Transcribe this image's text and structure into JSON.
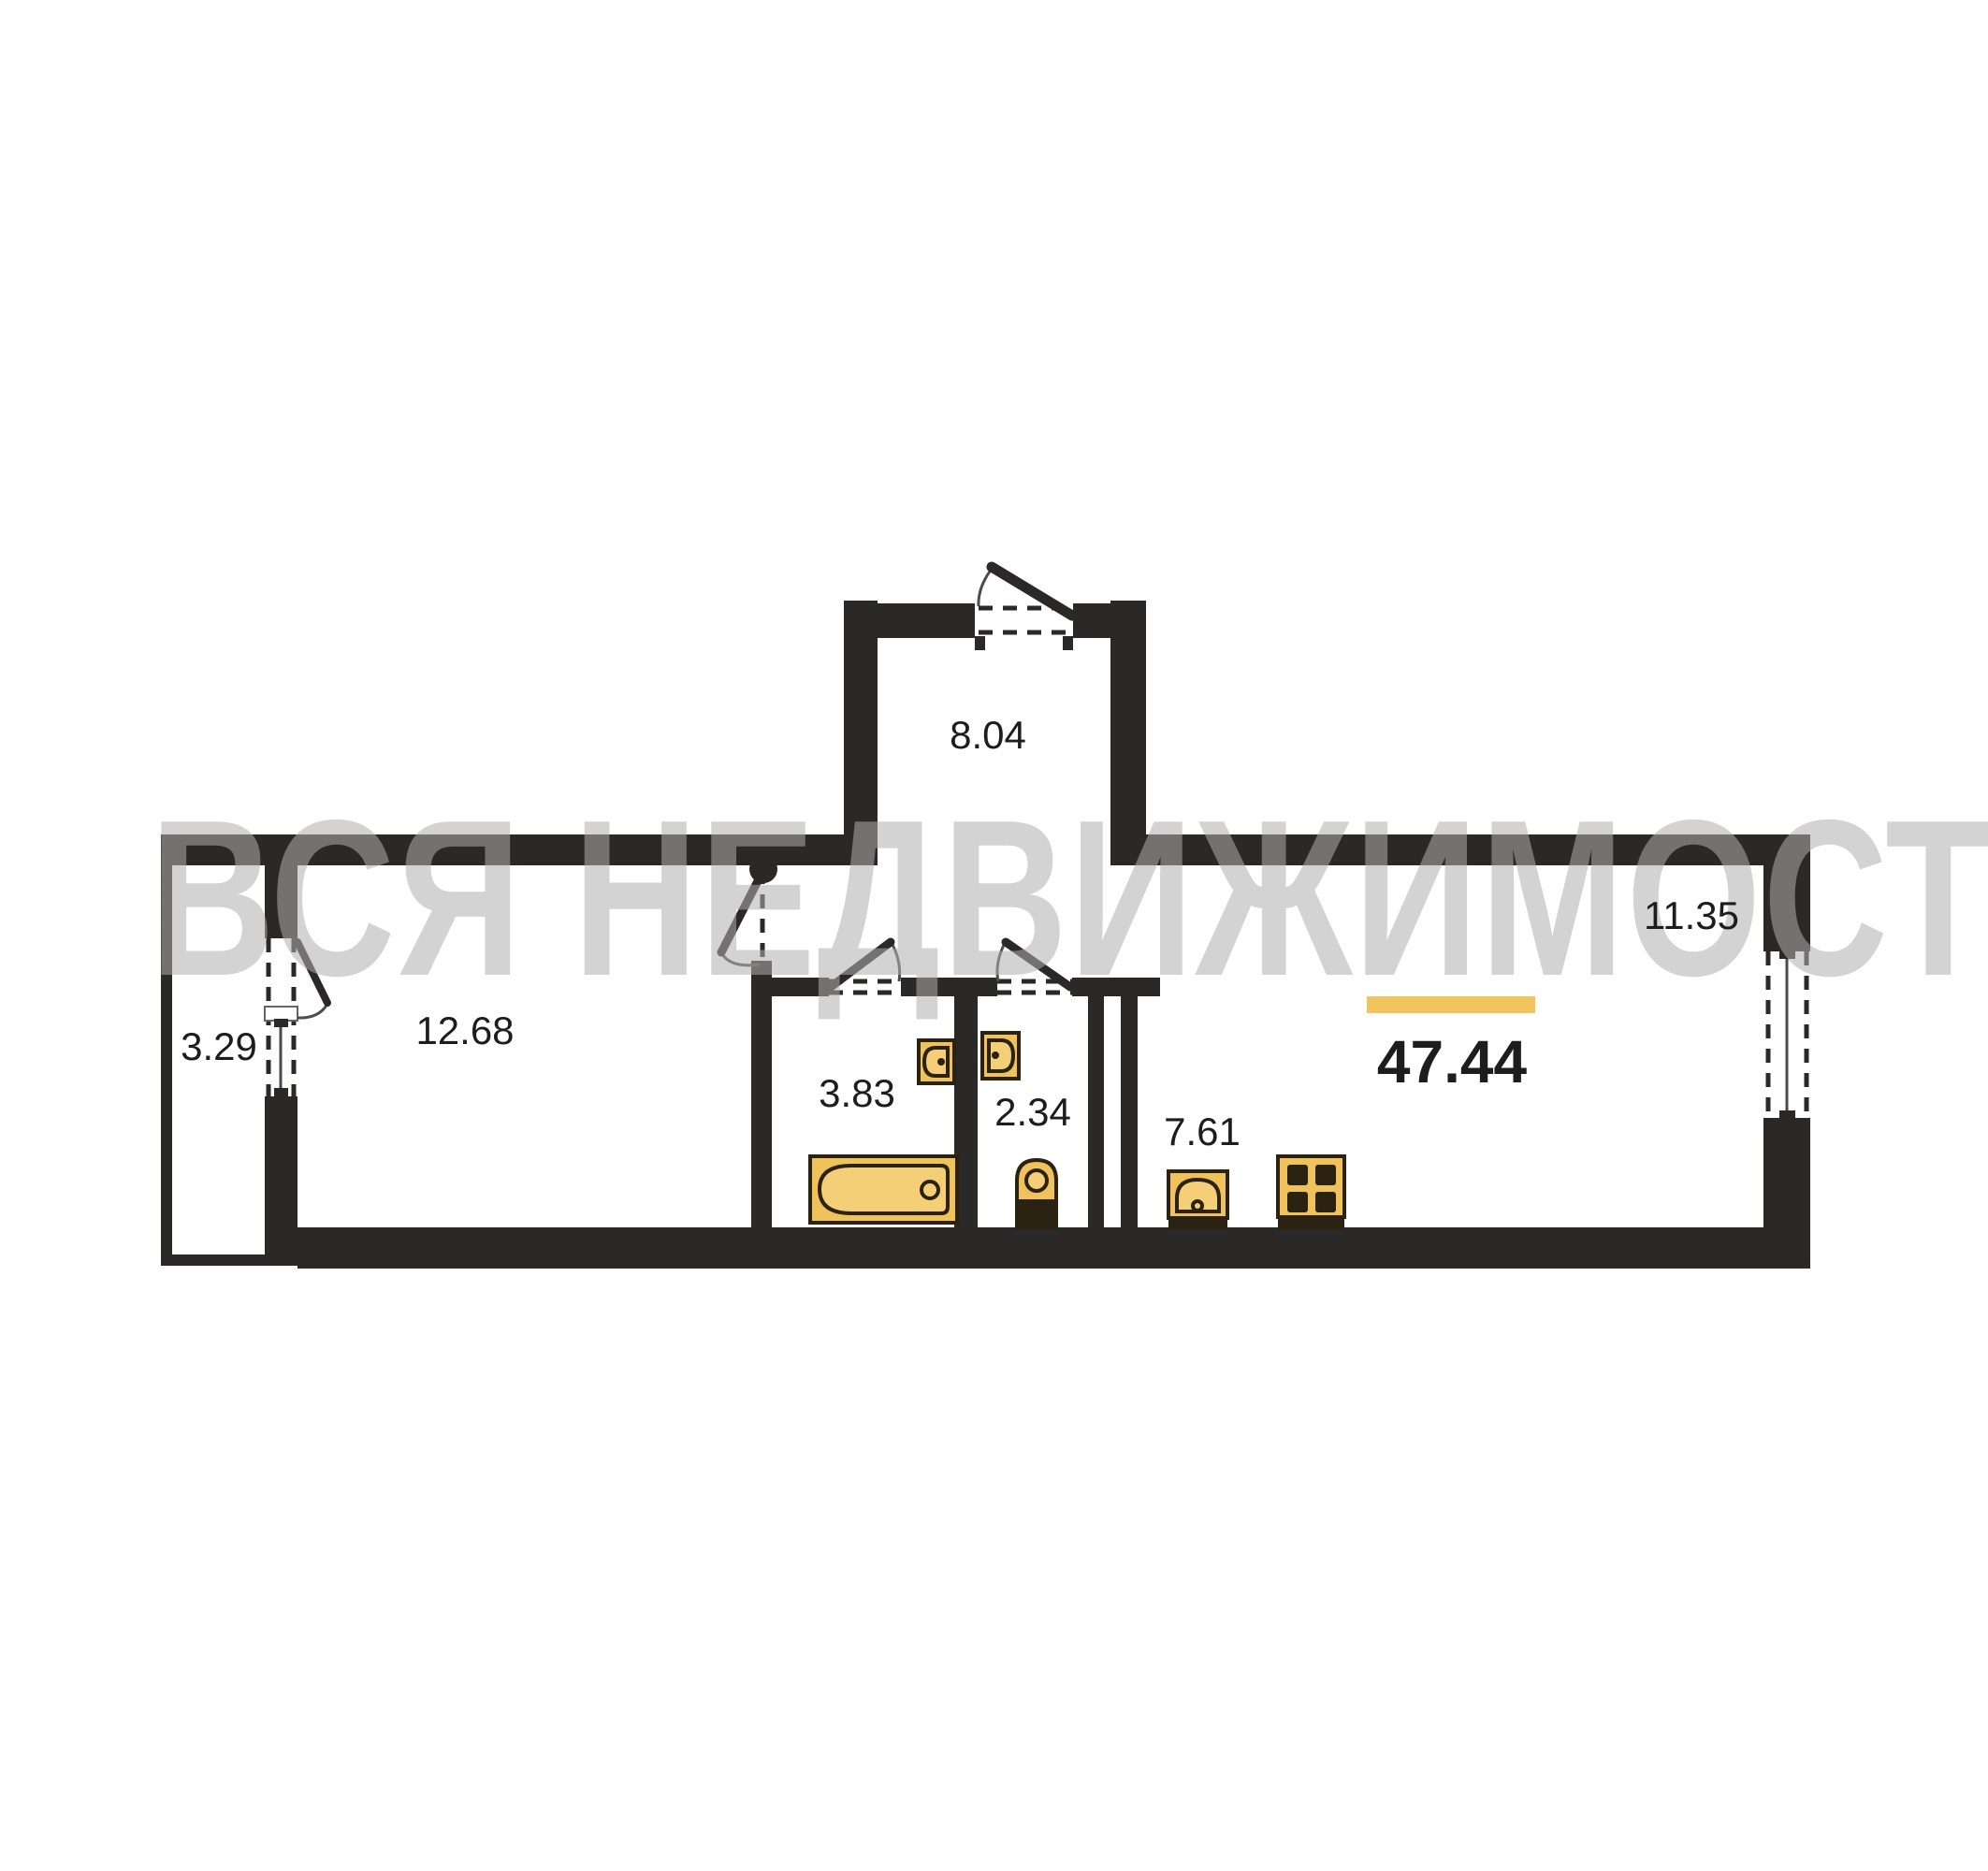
{
  "watermark": {
    "text": "ВСЯ НЕДВИЖИМОСТЬ"
  },
  "plan": {
    "total_area": "47.44",
    "rooms": {
      "entry_hall": {
        "area": "8.04"
      },
      "room": {
        "area": "12.68"
      },
      "balcony": {
        "area": "3.29"
      },
      "bathroom": {
        "area": "3.83"
      },
      "wc": {
        "area": "2.34"
      },
      "kitchen": {
        "area": "7.61"
      },
      "living_zone": {
        "area": "11.35"
      }
    }
  },
  "icons": [
    "bathtub-icon",
    "sink-icon",
    "sink-icon",
    "toilet-icon",
    "kitchen-sink-icon",
    "stove-icon",
    "door-icon",
    "window-icon"
  ],
  "colors": {
    "wall": "#2a2927",
    "fixture_fill": "#f0c25c",
    "fixture_fill_light": "#f5cf78",
    "fixture_stroke": "#2b2212",
    "accent_bar": "#f2c45e",
    "label": "#1d1d1d",
    "watermark": "rgba(175,175,175,0.55)",
    "background": "#ffffff",
    "glass": "#4a4a4a"
  }
}
